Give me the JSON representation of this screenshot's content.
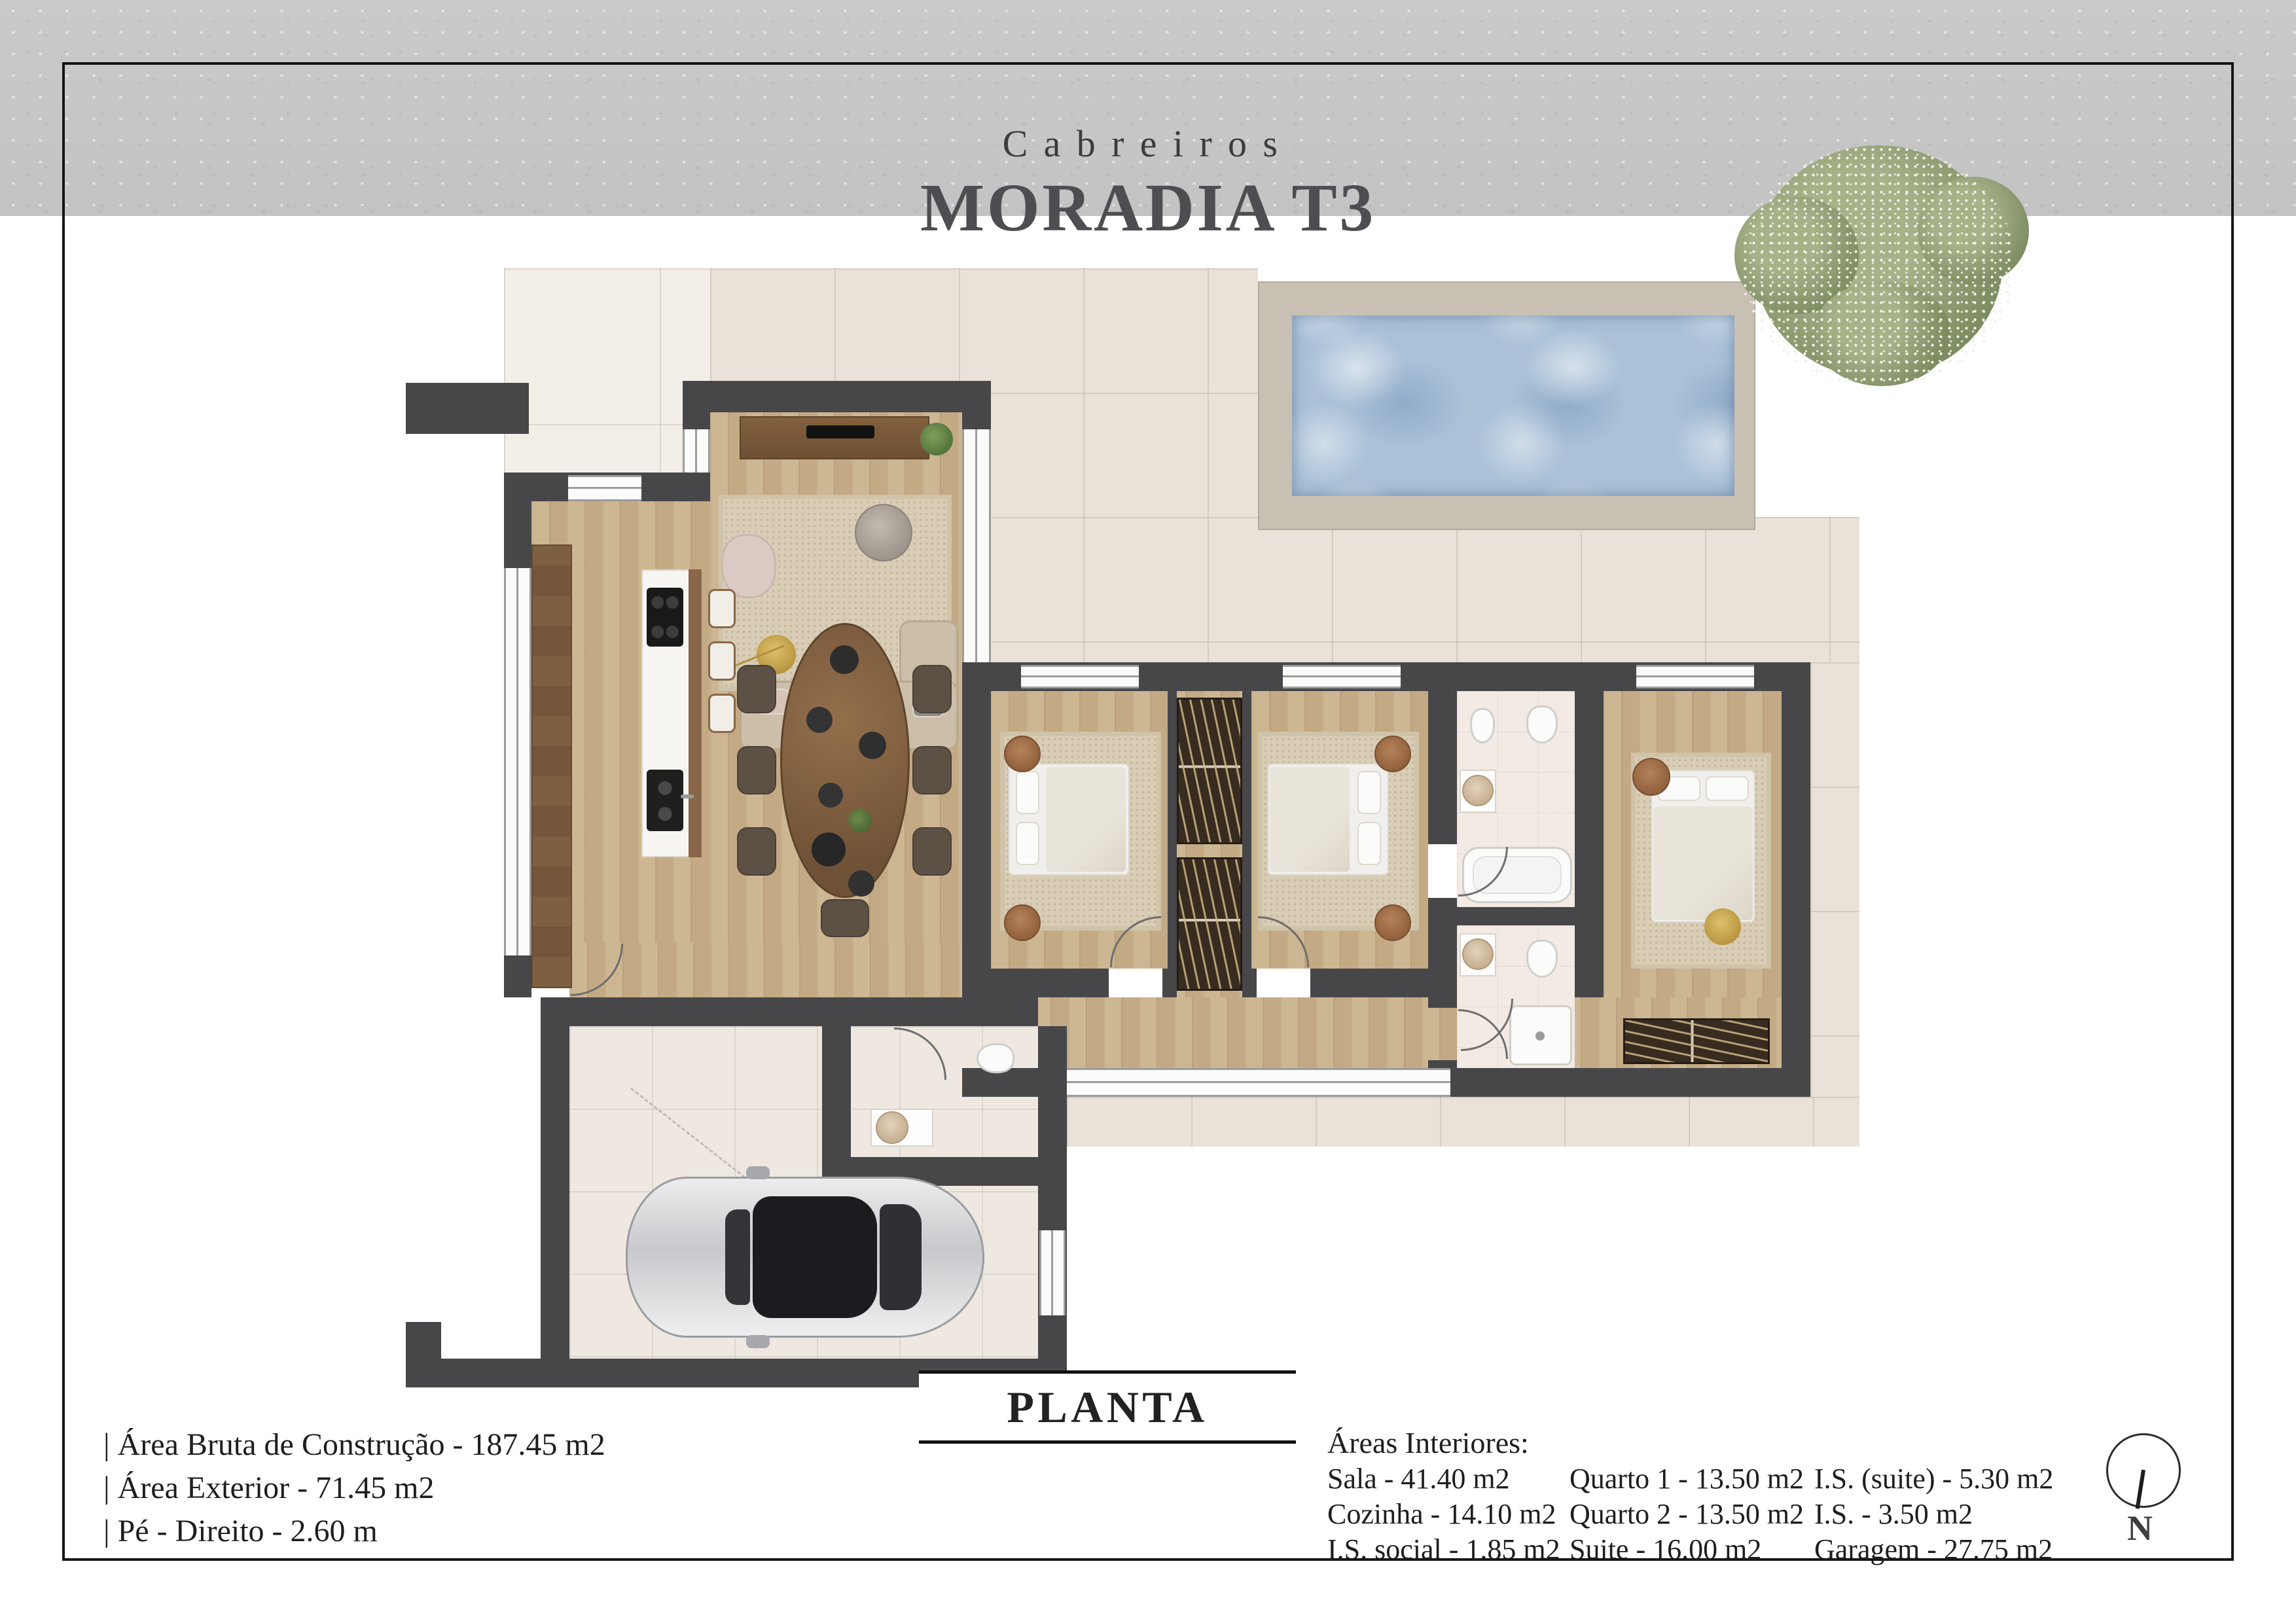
{
  "header": {
    "brand": "Cabreiros",
    "title": "MORADIA T3"
  },
  "plan": {
    "label": "PLANTA",
    "compass": "N"
  },
  "summary": {
    "lines": [
      "|  Área Bruta de Construção - 187.45 m2",
      "|  Área Exterior - 71.45 m2",
      "|  Pé - Direito - 2.60 m"
    ]
  },
  "interior_areas": {
    "heading": "Áreas Interiores:",
    "col1": [
      "Sala - 41.40 m2",
      "Cozinha - 14.10 m2",
      "I.S. social - 1.85 m2"
    ],
    "col2": [
      "Quarto 1 - 13.50 m2",
      "Quarto 2 - 13.50 m2",
      "Suite - 16.00 m2"
    ],
    "col3": [
      "I.S. (suite) - 5.30 m2",
      "I.S. - 3.50 m2",
      "Garagem - 27.75 m2"
    ]
  },
  "colors": {
    "wall": "#47474a",
    "wood_floor": "#c9b18d",
    "terrace_tile": "#eae2d8",
    "patio_tile": "#f3eee8",
    "pool_water": "#aac1d8",
    "pool_deck": "#c9c0b4",
    "footer_band": "#c7c7c7",
    "accent_gold": "#c8a84c",
    "tree_green": "#8a9770"
  }
}
